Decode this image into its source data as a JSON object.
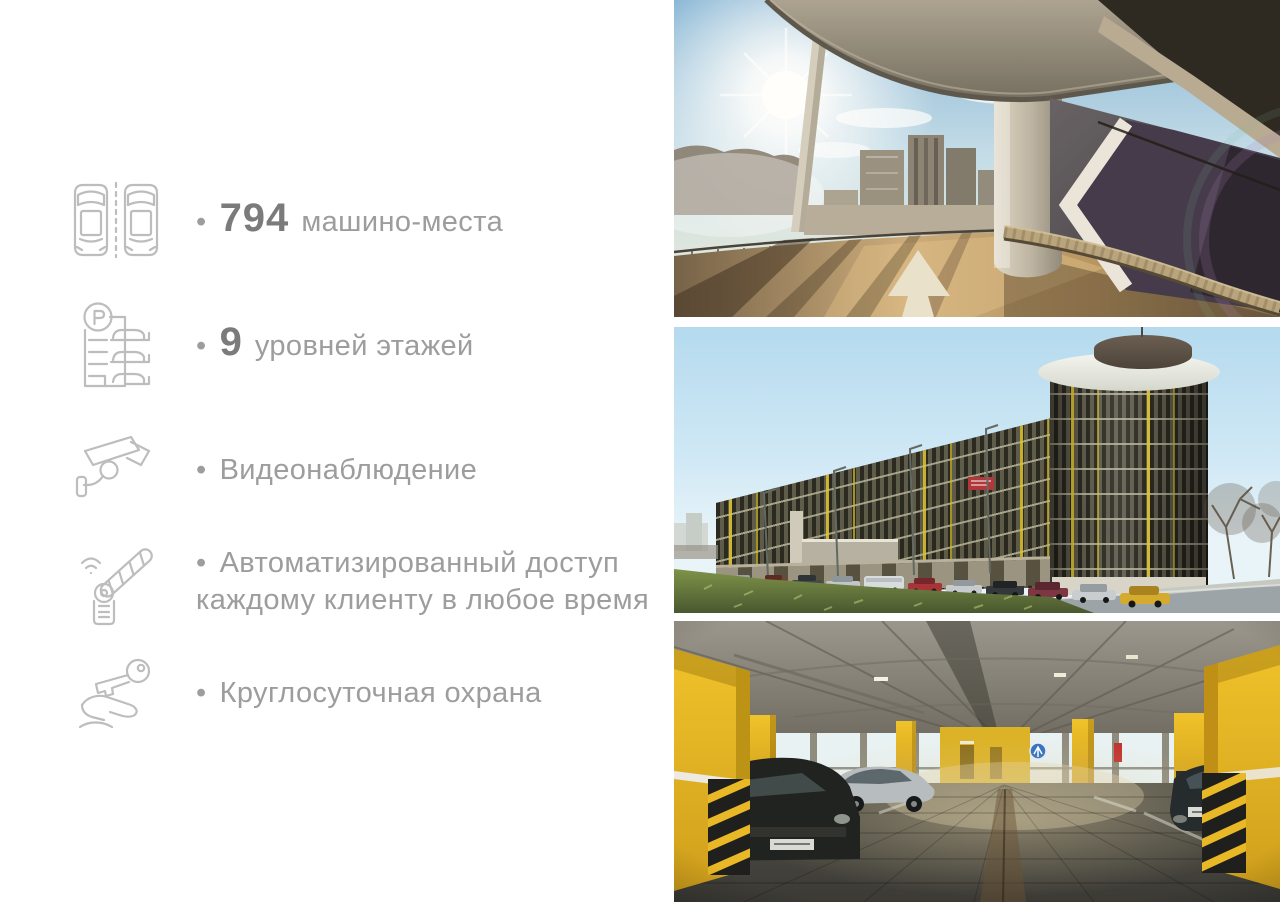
{
  "page": {
    "width": 1280,
    "height": 902,
    "background": "#ffffff"
  },
  "features": [
    {
      "icon": "two-cars-icon",
      "bullet": "•",
      "highlight": "794",
      "text": "машино-места"
    },
    {
      "icon": "parking-levels-icon",
      "bullet": "•",
      "highlight": "9",
      "text": "уровней этажей"
    },
    {
      "icon": "cctv-camera-icon",
      "bullet": "•",
      "highlight": "",
      "text": "Видеонаблюдение"
    },
    {
      "icon": "barrier-gate-icon",
      "bullet": "•",
      "highlight": "",
      "text": "Автоматизированный доступ",
      "text2": "каждому клиенту в любое время"
    },
    {
      "icon": "key-in-hand-icon",
      "bullet": "•",
      "highlight": "",
      "text": "Круглосуточная охрана"
    }
  ],
  "photos": [
    {
      "name": "parking-ramp-photo"
    },
    {
      "name": "parking-building-photo"
    },
    {
      "name": "parking-interior-photo"
    }
  ],
  "colors": {
    "text": "#9d9d9d",
    "number": "#7b7b7b",
    "icon_stroke": "#bdbdbd",
    "accent_yellow": "#eebc25",
    "wall_purple": "#3a3044",
    "sky": "#b5daee",
    "grass": "#6d8342"
  }
}
